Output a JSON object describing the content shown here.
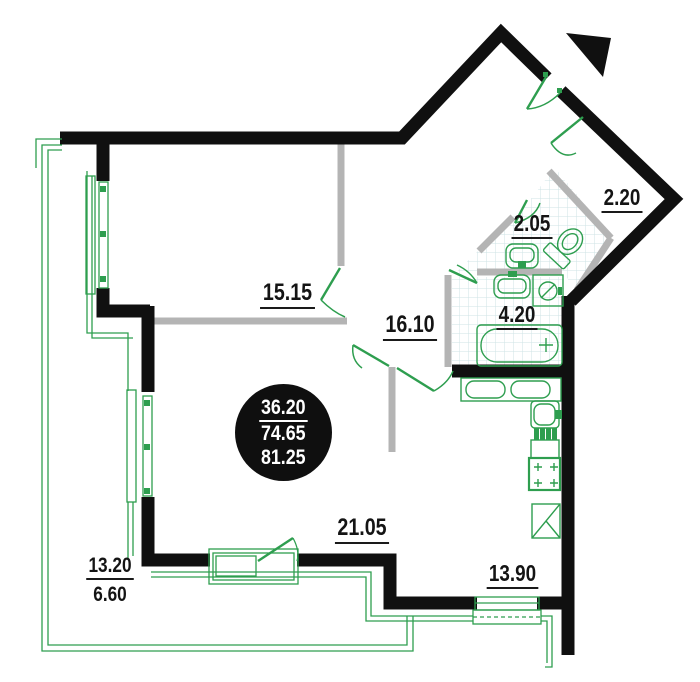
{
  "plan": {
    "title": "apartment floor plan",
    "rooms": [
      {
        "name": "room",
        "area": "15.15"
      },
      {
        "name": "hallway",
        "area": "16.10"
      },
      {
        "name": "wc",
        "area": "2.05"
      },
      {
        "name": "closet",
        "area": "2.20"
      },
      {
        "name": "bathroom",
        "area": "4.20"
      },
      {
        "name": "living-room",
        "area": "21.05"
      },
      {
        "name": "kitchen",
        "area": "13.90"
      }
    ],
    "balcony": {
      "area_full": "13.20",
      "area_counted": "6.60"
    },
    "area_summary": {
      "living_area": "36.20",
      "usable_area": "74.65",
      "total_area": "81.25"
    },
    "colors": {
      "walls": "#101010",
      "partitions": "#b4b4b4",
      "fixtures_green": "#2e9e4f",
      "tile_grid": "#cfe3e6",
      "badge_bg": "#0f0f0f",
      "badge_text": "#ffffff"
    },
    "icons": [
      "entrance-arrow",
      "door-swing",
      "window",
      "balcony-railing",
      "toilet",
      "wc-sink",
      "bathroom-sink",
      "washing-machine",
      "bathtub",
      "kitchen-counter",
      "kitchen-sink",
      "dish-rack",
      "stove",
      "cabinet"
    ]
  }
}
